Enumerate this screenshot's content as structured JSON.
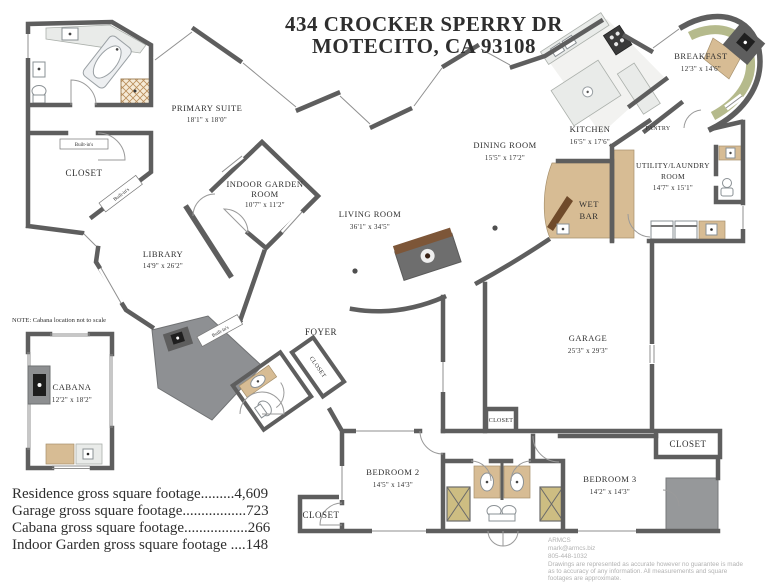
{
  "title": {
    "line1": "434 CROCKER SPERRY DR",
    "line2": "MOTECITO, CA 93108"
  },
  "rooms": {
    "primary_suite": {
      "name": "PRIMARY SUITE",
      "dims": "18'1\" x 18'0\""
    },
    "library": {
      "name": "LIBRARY",
      "dims": "14'9\" x 26'2\""
    },
    "indoor_garden": {
      "name_line1": "INDOOR GARDEN",
      "name_line2": "ROOM",
      "dims": "10'7\" x 11'2\""
    },
    "living": {
      "name": "LIVING ROOM",
      "dims": "36'1\" x 34'5\""
    },
    "dining": {
      "name": "DINING ROOM",
      "dims": "15'5\" x 17'2\""
    },
    "kitchen": {
      "name": "KITCHEN",
      "dims": "16'5\" x 17'6\""
    },
    "pantry": {
      "name": "PANTRY"
    },
    "breakfast": {
      "name": "BREAKFAST",
      "dims": "12'3\" x 14'6\""
    },
    "utility": {
      "name_line1": "UTILITY/LAUNDRY",
      "name_line2": "ROOM",
      "dims": "14'7\" x 15'1\""
    },
    "wet_bar": {
      "name_line1": "WET",
      "name_line2": "BAR"
    },
    "garage": {
      "name": "GARAGE",
      "dims": "25'3\" x 29'3\""
    },
    "foyer": {
      "name": "FOYER"
    },
    "cabana": {
      "name": "CABANA",
      "dims": "12'2\" x 18'2\""
    },
    "bedroom2": {
      "name": "BEDROOM 2",
      "dims": "14'5\" x 14'3\""
    },
    "bedroom3": {
      "name": "BEDROOM 3",
      "dims": "14'2\" x 14'3\""
    },
    "closet_label": "CLOSET",
    "built_ins_label": "Built-in's"
  },
  "note": "NOTE: Cabana location not to scale",
  "footage": {
    "lines": [
      "Residence gross square footage.........4,609",
      "Garage gross square footage.................723",
      "Cabana gross square footage.................266",
      "Indoor Garden gross square footage ....148"
    ]
  },
  "credits": {
    "company": "ARMCS",
    "email": "mark@armcs.biz",
    "phone": "805-448-1032",
    "disclaimer_line1": "Drawings are represented as accurate however no guarantee is made",
    "disclaimer_line2": "as to accuracy of any information. All measurements and square",
    "disclaimer_line3": "footages are approximate."
  },
  "colors": {
    "wall": "#5e5e5e",
    "cabinet_tan": "#d7bc94",
    "breakfast_olive": "#b5ba8c",
    "terrace_gray": "#8e9093",
    "bar_brown": "#6f4a2a",
    "fixture_gray": "#edeff1",
    "label_text": "#2e2e2e",
    "credit_text": "#b2b2b2"
  }
}
